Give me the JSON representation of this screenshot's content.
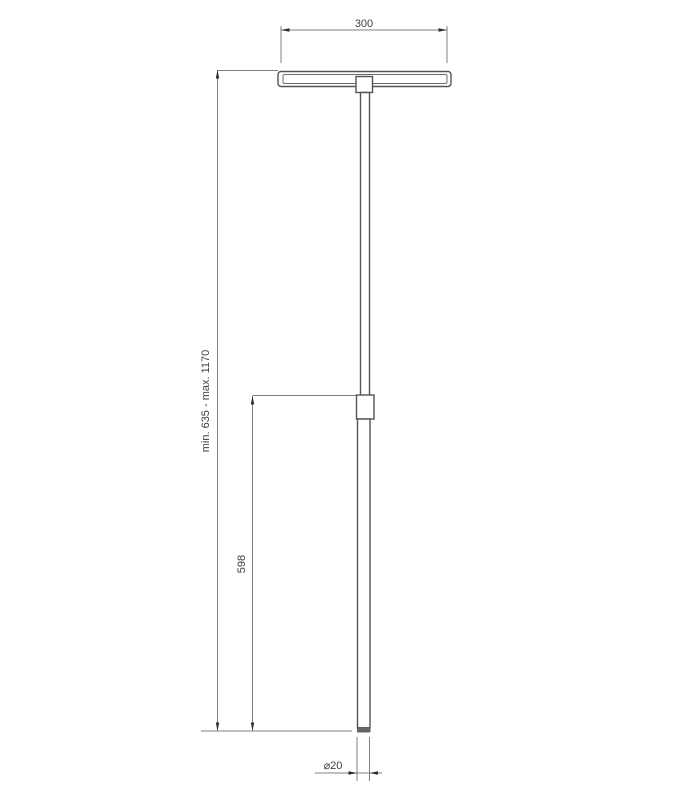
{
  "drawing": {
    "type": "technical-dimension-drawing",
    "object": "telescoping pole lamp, front elevation"
  },
  "colors": {
    "background": "#ffffff",
    "object_line": "#53545a",
    "object_line_light": "#6a6b6f",
    "dimension_line": "#7f8084",
    "arrow": "#2b2c2e",
    "text": "#3f4043"
  },
  "dimensions": {
    "head_width_label": "300",
    "overall_height_label": "min. 635 - max. 1170",
    "lower_tube_label": "598",
    "diameter_label": "⌀20"
  }
}
